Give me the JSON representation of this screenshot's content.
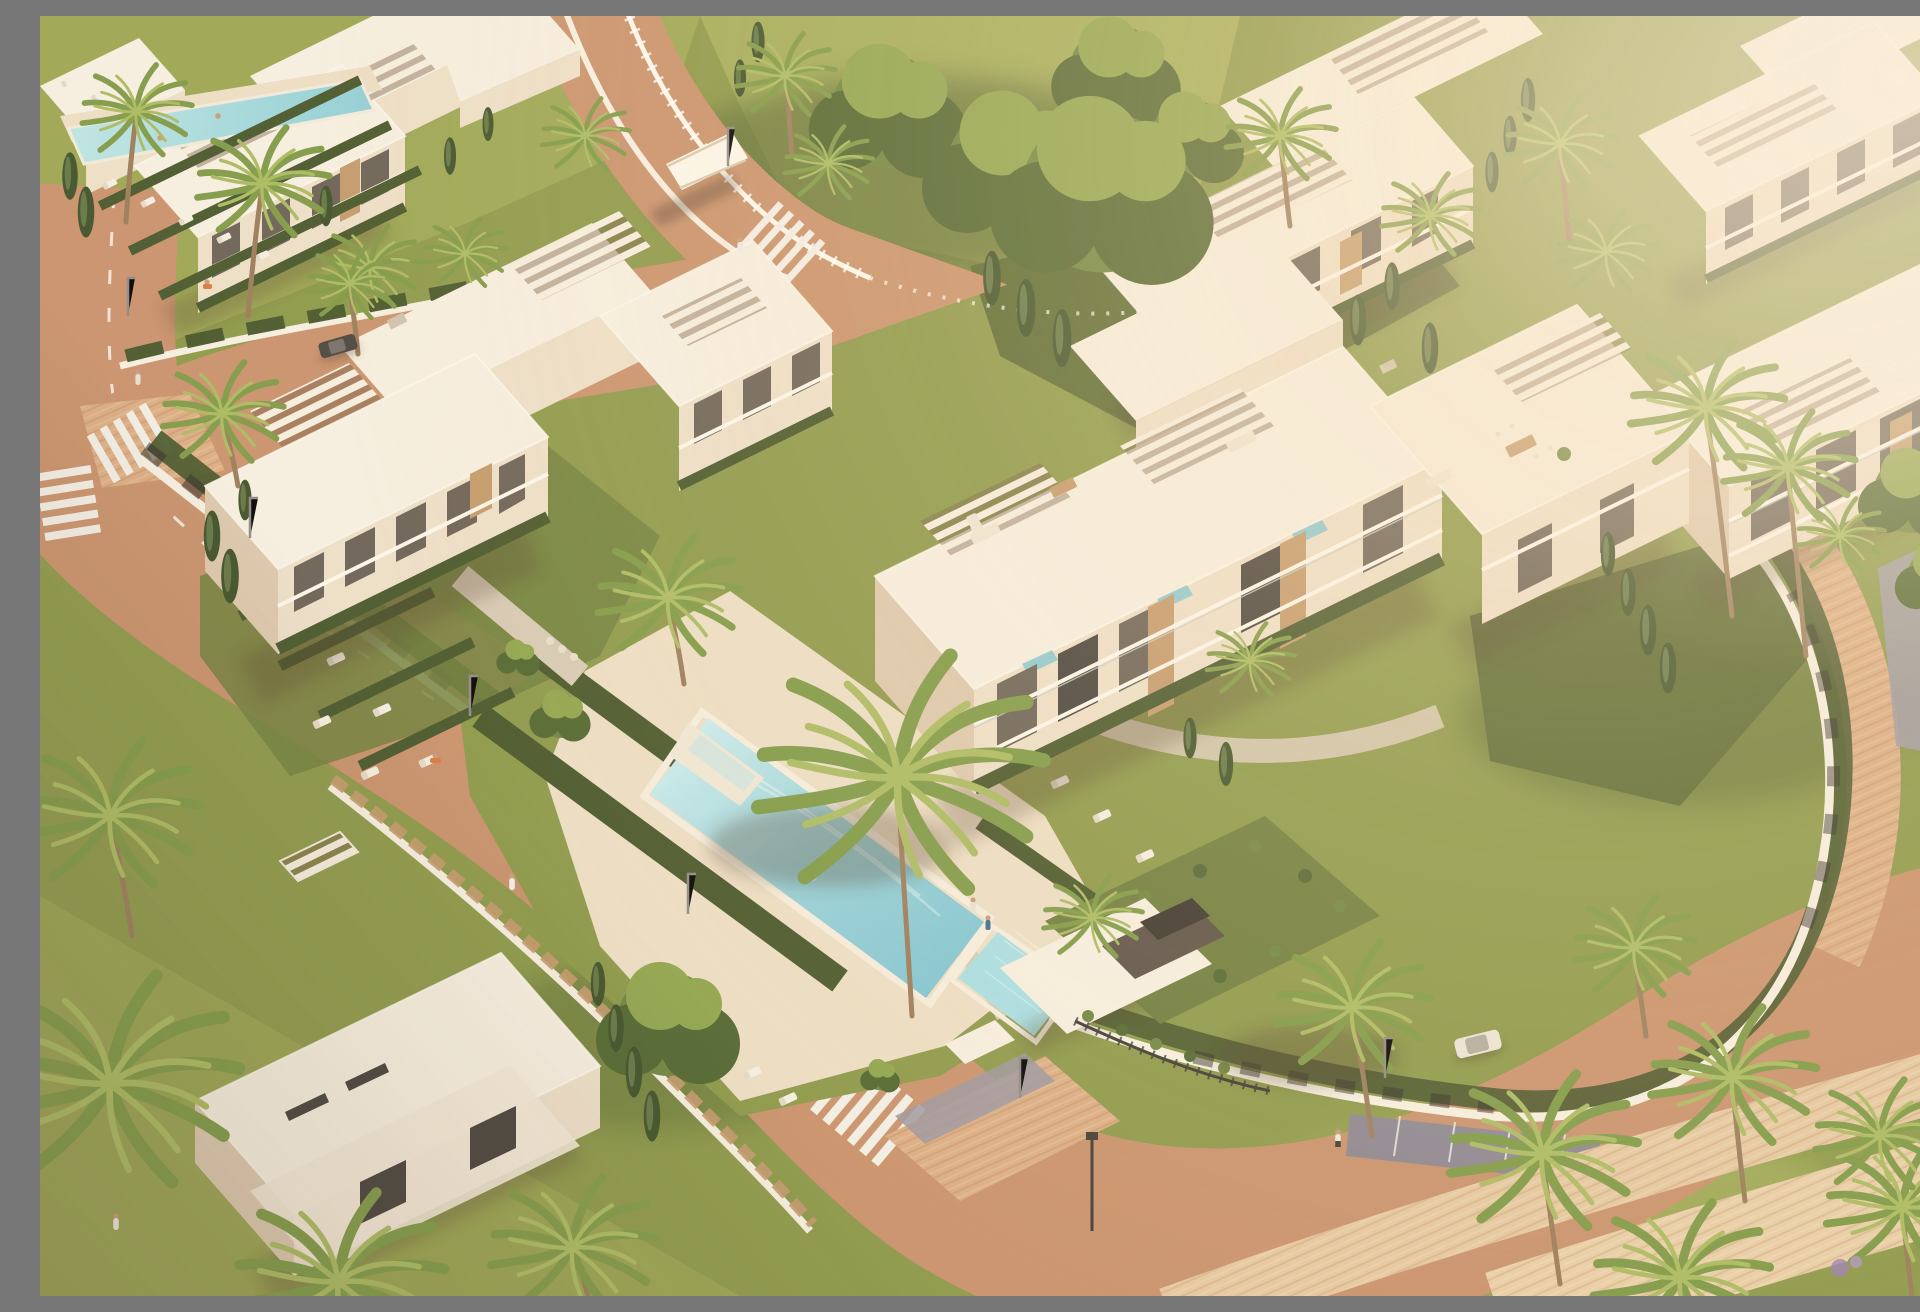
{
  "scene": {
    "type": "3d-architectural-aerial-render",
    "description": "Golden-hour aerial rendering of a modern white low-rise apartment complex: flat-roofed buildings with pergolas, terraced balconies and wood-slat screens around a central garden with a long turquoise swimming pool, a small children's pool, sun loungers and clipped hedges; curving asphalt streets with dashed lane markings, zebra crossings and terracotta brick sidewalks; a gated entrance with a green-roofed underground parking ramp; neighbouring white residential buildings among palms, cypresses and leafy trees; palm-lined brick promenade in the foreground with a parked white car and pedestrians.",
    "time_of_day": "late-afternoon golden hour",
    "camera": "high oblique aerial view"
  },
  "palette": {
    "white": "#f7f0e1",
    "whiteBright": "#fdf8ec",
    "whiteShade": "#eee0c9",
    "whiteDeep": "#ddc9ae",
    "window": "#6a6155",
    "windowDark": "#46413a",
    "wood": "#c39a6b",
    "woodDark": "#9c7347",
    "road": "#a09ba3",
    "roadDark": "#8b8691",
    "marking": "#f3f0e7",
    "brick": "#c9926c",
    "brickLight": "#dcae83",
    "brickPale": "#e6c9a0",
    "deck": "#eddfc5",
    "gravel": "#d7cab4",
    "grass": "#8c9949",
    "grassBright": "#a3ad58",
    "grassDark": "#70803c",
    "lawnShade": "#5a6a31",
    "hedge": "#47572a",
    "cypress": "#3e5129",
    "treeLight": "#8fa54d",
    "treeMid": "#6e8540",
    "treeDark": "#50662f",
    "palmLight": "#aabb60",
    "palmMid": "#7e9a45",
    "trunk": "#9a7c59",
    "pool": "#98d4dc",
    "poolDeep": "#7ec4d2",
    "poolLight": "#cdeef0",
    "poolKids": "#a8dfe4",
    "skin": "#c79c78",
    "carBody": "#ece6d8",
    "carDark": "#4a453f",
    "shadowC": "rgba(80,60,40,0.32)",
    "glow": "#ffe4ba"
  },
  "objects": {
    "buildings": [
      {
        "id": "top-left-complex",
        "style": "white modern block, rooftop pergolas, lap-pool terrace with loungers"
      },
      {
        "id": "center-left-building",
        "style": "white stepped apartment block with tiered hedge garden"
      },
      {
        "id": "center-right-building",
        "style": "white apartment block, roof terraces, pergolas, plunge pools, outdoor lounges"
      },
      {
        "id": "top-center-building",
        "style": "white apartment block behind large leafy tree"
      },
      {
        "id": "top-right-building",
        "style": "white apartment block with pergola roof"
      },
      {
        "id": "right-edge-building",
        "style": "white apartment block with balcony rows"
      },
      {
        "id": "bottom-left-villa",
        "style": "white flat-roof villa"
      },
      {
        "id": "entrance-garage",
        "style": "green-roofed underground parking entrance with gate"
      }
    ],
    "pools": [
      {
        "id": "main-pool",
        "shape": "long rectangle with beach-entry ramp",
        "water": "turquoise"
      },
      {
        "id": "kids-pool",
        "shape": "small square",
        "water": "pale tiled blue"
      },
      {
        "id": "lap-pool",
        "where": "top-left complex terrace"
      }
    ],
    "roads": [
      {
        "id": "main-road",
        "features": [
          "dashed lane markings",
          "zebra crossings",
          "street lights",
          "parking bay"
        ]
      },
      {
        "id": "upper-road",
        "features": [
          "retaining walls",
          "footbridge",
          "zebra crossing"
        ]
      },
      {
        "id": "link-street",
        "features": [
          "palm-lined sidewalk",
          "parked dark car"
        ]
      }
    ],
    "vegetation": {
      "palms": "many",
      "cypresses": "many",
      "leafy_trees": "several",
      "hedges": "clipped dark hedges",
      "lawns": "sunlit terraced lawns"
    },
    "people": [
      {
        "where": "upper-road crossing"
      },
      {
        "where": "top-left sidewalk"
      },
      {
        "where": "left sidewalk"
      },
      {
        "where": "main road jogger"
      },
      {
        "where": "promenade"
      },
      {
        "where": "top-left lawn"
      },
      {
        "where": "swimming in main pool"
      },
      {
        "where": "standing at pool end"
      },
      {
        "where": "sunbathing on lounger"
      }
    ],
    "vehicles": [
      {
        "id": "white-car",
        "where": "roadside parking bay"
      },
      {
        "id": "dark-car",
        "where": "link street"
      }
    ],
    "furniture": {
      "sun_loungers": "clusters at pools and lawn tiers",
      "roof_sofas": "beige outdoor lounges",
      "dining_sets": "wood tables on roof terraces"
    }
  }
}
